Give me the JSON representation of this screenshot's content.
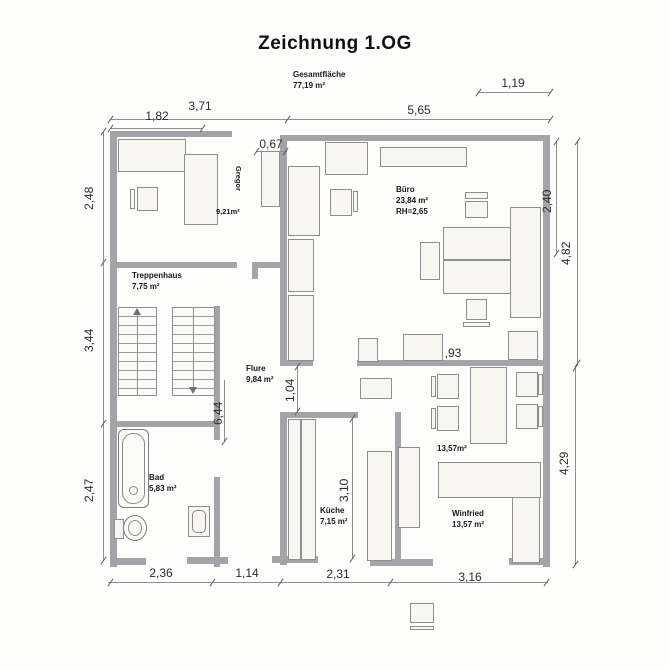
{
  "title": "Zeichnung 1.OG",
  "summary": {
    "label": "Gesamtfläche",
    "value": "77,19 m²"
  },
  "rooms": {
    "gregor": {
      "name": "Gregor",
      "area": "9,21m²"
    },
    "buero": {
      "name": "Büro",
      "area": "23,84 m²",
      "height": "RH=2,65"
    },
    "treppenhaus": {
      "name": "Treppenhaus",
      "area": "7,75 m²"
    },
    "flure": {
      "name": "Flure",
      "area": "9,84 m²"
    },
    "bad": {
      "name": "Bad",
      "area": "5,83 m²"
    },
    "kueche": {
      "name": "Küche",
      "area": "7,15 m²"
    },
    "winfried": {
      "name": "Winfried",
      "area": "13,57 m²",
      "area_upper": "13,57m²"
    }
  },
  "dims": {
    "top_1": "1,82",
    "top_2": "3,71",
    "top_3": "0,67",
    "top_4": "5,65",
    "top_5": "1,19",
    "left_1": "2,48",
    "left_2": "3,44",
    "left_3": "2,47",
    "right_1": "2,40",
    "right_2": "4,82",
    "right_3": "4,29",
    "mid_1": "6,44",
    "mid_2": "1,04",
    "mid_3": "3,10",
    "mid_4": ",93",
    "bottom_1": "2,36",
    "bottom_2": "1,14",
    "bottom_3": "2,31",
    "bottom_4": "3,16"
  },
  "colors": {
    "wall": "#a4a4a8",
    "line": "#8f8f8f",
    "furniture_fill": "#f7f6f1",
    "text": "#1c1c1c"
  }
}
